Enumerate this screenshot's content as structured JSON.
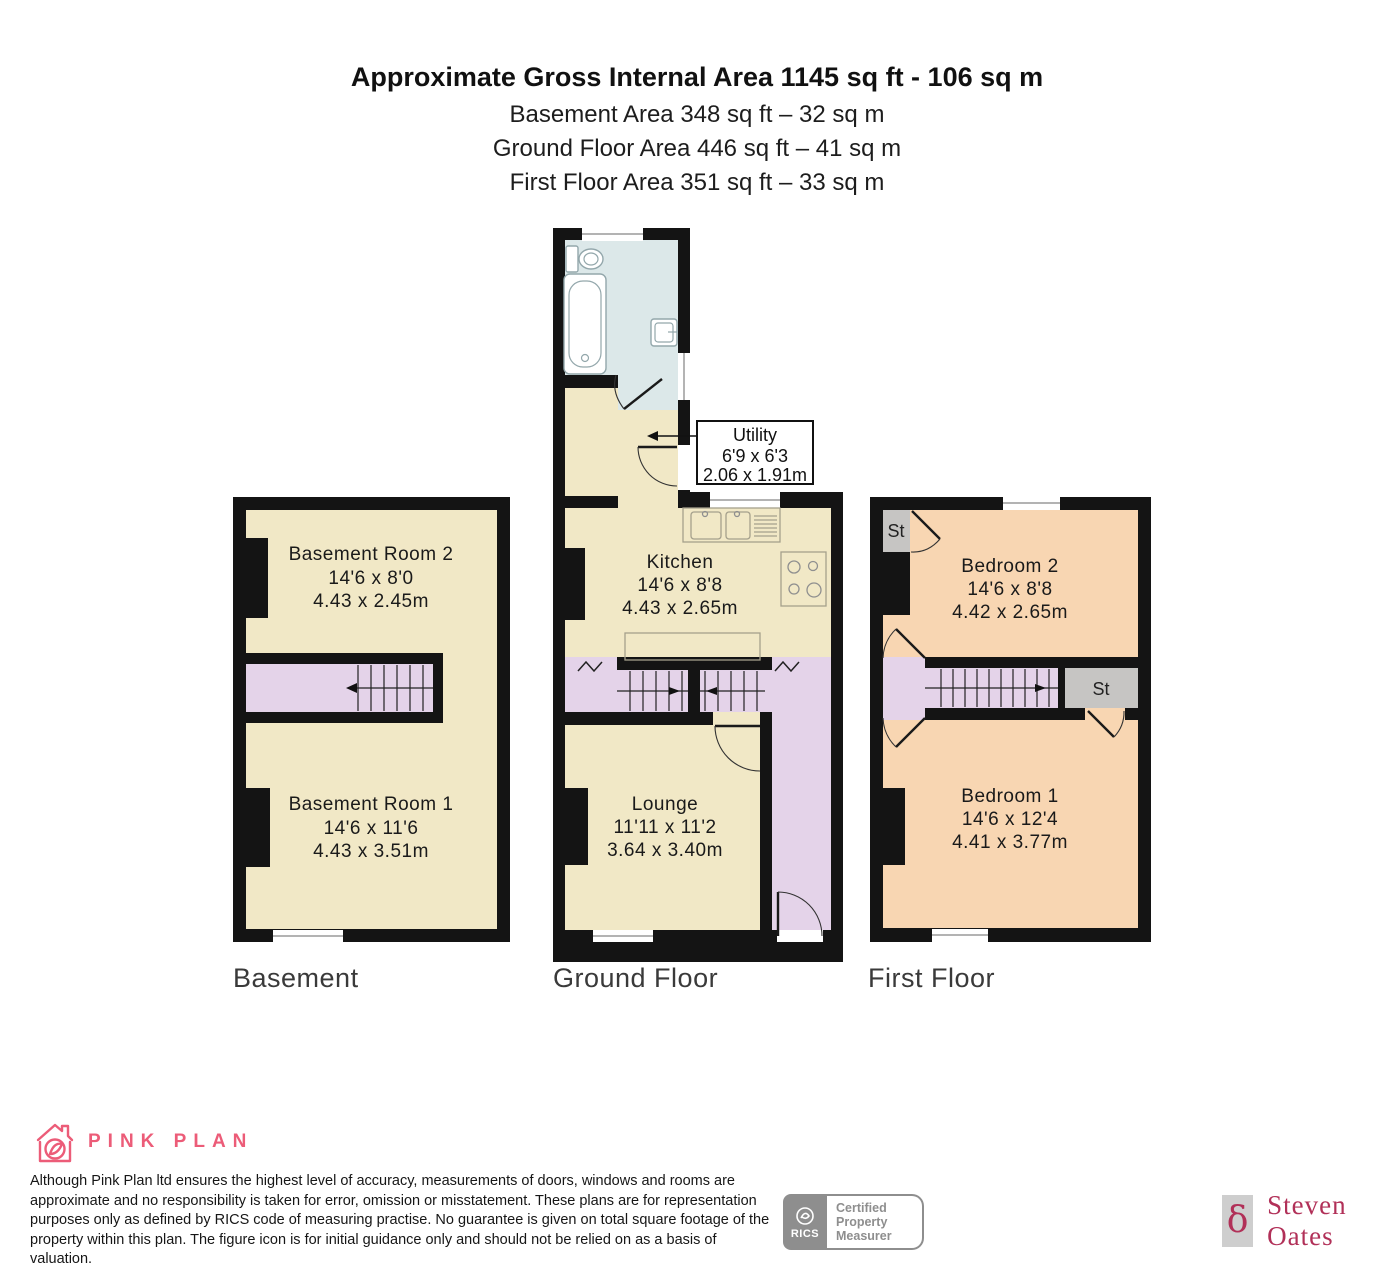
{
  "header": {
    "title": "Approximate Gross Internal Area 1145 sq ft - 106 sq m",
    "subtitle_lines": [
      "Basement Area 348 sq ft – 32 sq m",
      "Ground Floor Area 446 sq ft – 41 sq m",
      "First Floor Area 351 sq ft – 33 sq m"
    ]
  },
  "floors": {
    "basement": {
      "label": "Basement",
      "room2": {
        "name": "Basement Room 2",
        "imperial": "14'6 x 8'0",
        "metric": "4.43 x 2.45m"
      },
      "room1": {
        "name": "Basement Room 1",
        "imperial": "14'6 x 11'6",
        "metric": "4.43 x 3.51m"
      }
    },
    "ground": {
      "label": "Ground Floor",
      "kitchen": {
        "name": "Kitchen",
        "imperial": "14'6 x 8'8",
        "metric": "4.43 x 2.65m"
      },
      "lounge": {
        "name": "Lounge",
        "imperial": "11'11 x 11'2",
        "metric": "3.64 x 3.40m"
      },
      "utility": {
        "name": "Utility",
        "imperial": "6'9 x 6'3",
        "metric": "2.06 x 1.91m"
      }
    },
    "first": {
      "label": "First Floor",
      "bedroom2": {
        "name": "Bedroom 2",
        "imperial": "14'6 x 8'8",
        "metric": "4.42 x 2.65m"
      },
      "bedroom1": {
        "name": "Bedroom 1",
        "imperial": "14'6 x 12'4",
        "metric": "4.41 x 3.77m"
      },
      "storage": "St"
    }
  },
  "footer": {
    "brand": "PINK PLAN",
    "disclaimer_lines": [
      "Although Pink Plan ltd ensures the highest level of accuracy, measurements of doors, windows and rooms are",
      "approximate and no responsibility is taken for error, omission or misstatement. These plans are for representation",
      "purposes only as defined by RICS code of measuring practise. No guarantee is given on total square footage of the",
      "property within this plan. The figure icon is for initial guidance only and should not be relied on as a basis of valuation."
    ],
    "rics_wordmark": "RICS",
    "rics_lines": [
      "Certified",
      "Property",
      "Measurer"
    ],
    "agent_symbol": "δ",
    "agent_name": "Steven Oates"
  },
  "colors": {
    "wall": "#141414",
    "room_cream": "#f1e8c6",
    "stairs_lilac": "#e4d3e9",
    "bedroom_peach": "#f8d6b2",
    "bathroom_blue": "#dce8e9",
    "storage_gray": "#c6c5c3",
    "brand_pink": "#ec5c78",
    "agent_crimson": "#b13058"
  }
}
